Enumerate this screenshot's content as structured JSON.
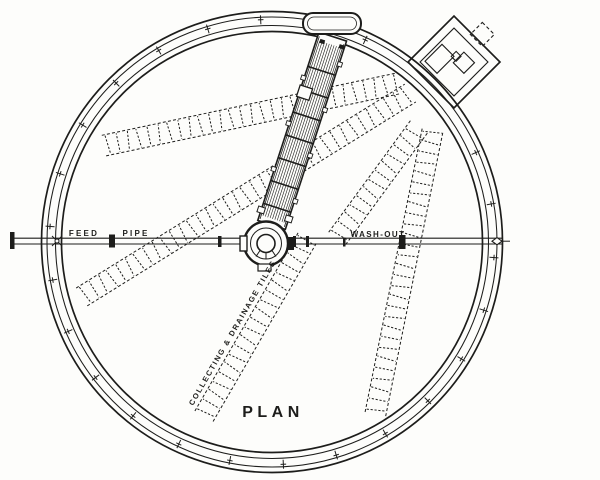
{
  "drawing_title": "PLAN",
  "colors": {
    "ink": "#1d1d1b",
    "paper": "#fdfdfb"
  },
  "labels": {
    "feed": "FEED",
    "pipe": "PIPE",
    "wash_out": "WASH-OUT",
    "tiles": "COLLECTING & DRAINAGE TILES",
    "plan": "PLAN"
  },
  "diagram": {
    "type": "engineering-plan",
    "subject": "circular tank with rotating distributor arm, feed and wash-out pipes, drainage tile runs",
    "center": {
      "x": 272,
      "y": 242
    },
    "rim_radii": [
      230.5,
      225,
      216.5,
      210.5
    ],
    "rim_stroke_widths": [
      1.7,
      1.05,
      1.05,
      1.7
    ],
    "tick": {
      "count": 26,
      "radius": 222.5,
      "start_deg": 4,
      "skip_from_deg": -62,
      "skip_to_deg": -30
    },
    "band_width": 21,
    "band_step": 10.5,
    "bands": [
      {
        "x1": 102,
        "y1": 146,
        "x2": 400,
        "y2": 83
      },
      {
        "x1": 80,
        "y1": 298,
        "x2": 412,
        "y2": 92
      },
      {
        "x1": 336,
        "y1": 240,
        "x2": 421,
        "y2": 124
      },
      {
        "x1": 375,
        "y1": 416,
        "x2": 433,
        "y2": 128
      },
      {
        "x1": 203,
        "y1": 418,
        "x2": 309,
        "y2": 235
      }
    ],
    "arm": {
      "cx": 266,
      "cy": 242,
      "rotate_deg": 18,
      "half_width": 14.5,
      "y_top": -216,
      "y_bottom": -18,
      "rung_step": 24
    }
  }
}
